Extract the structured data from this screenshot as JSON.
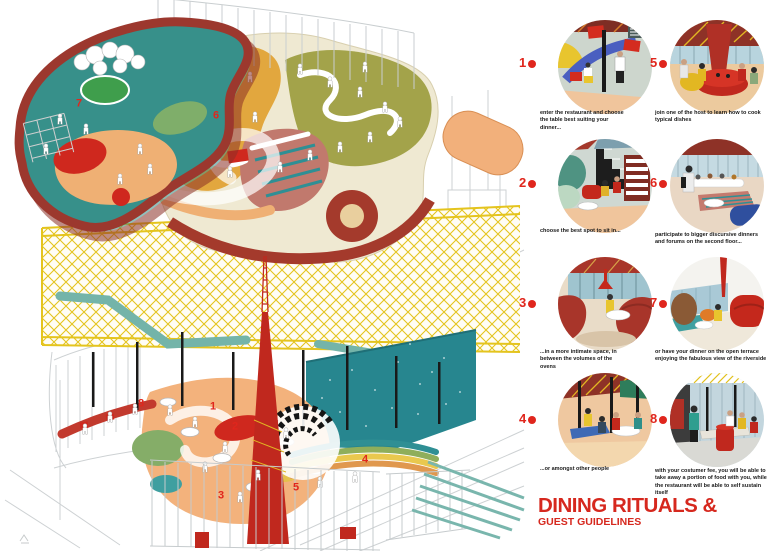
{
  "palette": {
    "accent_red": "#e0261d",
    "maroon": "#a43a2c",
    "teal": "#2f9094",
    "ochre": "#e2a73e",
    "olive": "#a3a34a",
    "truss_yellow": "#e4c41e",
    "rose": "#c1796d",
    "peach": "#f3b27c",
    "pond_green": "#3f9e4c"
  },
  "title": {
    "line1": "DINING RITUALS &",
    "line2": "GUEST GUIDELINES"
  },
  "axon": {
    "labels": [
      "1",
      "2",
      "3",
      "4",
      "5",
      "6",
      "7",
      "8"
    ]
  },
  "steps": [
    {
      "num": "1",
      "caption": "enter the restaurant and choose the table best suiting your dinner..."
    },
    {
      "num": "2",
      "caption": "choose the best spot to sit in..."
    },
    {
      "num": "3",
      "caption": "...in a more intimate space, in between the volumes of the ovens"
    },
    {
      "num": "4",
      "caption": "...or amongst other people"
    },
    {
      "num": "5",
      "caption": "join one of the host to learn how to cook typical dishes"
    },
    {
      "num": "6",
      "caption": "participate to bigger discursive dinners and forums on the second floor..."
    },
    {
      "num": "7",
      "caption": "or have your dinner on the open terrace enjoying the fabulous view of the riverside"
    },
    {
      "num": "8",
      "caption": "with your costumer fee, you will be able to take away a portion of food with you, while the restaurant will be able to self sustain itself"
    }
  ]
}
